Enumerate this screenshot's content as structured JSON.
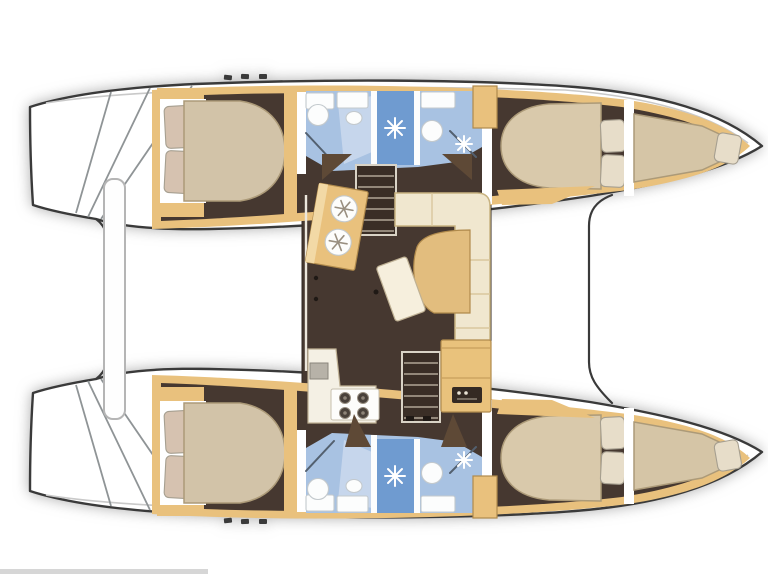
{
  "figure": {
    "kind": "catamaran-interior-floor-plan",
    "view": "top-down",
    "bow_direction": "right"
  },
  "palette": {
    "background": "#ffffff",
    "outline": "#3a3a3a",
    "hull_white": "#ffffff",
    "floor_dark": "#463830",
    "trim_tan": "#e9c17d",
    "unit_light": "#f2d9a6",
    "wedge_dark": "#5e4936",
    "bed_cream": "#d2c3a8",
    "pillow_blush": "#d6c2b0",
    "pillow_cream": "#e7ddc9",
    "berth_cream": "#d9c9ab",
    "bow_cream": "#d5c5a6",
    "bath_blue": "#a8c2e2",
    "bath_pale": "#c6d6ec",
    "shower_blue": "#6f9bd0",
    "fixture_white": "#fcfdfd",
    "settee_cream": "#f0e7cf",
    "settee_tan": "#e2bd7e",
    "table_white": "#f6efdd",
    "counter_white": "#f4f0e4",
    "sink_gray": "#b7b2a8",
    "stove_white": "#fdfdfb",
    "burner_dark": "#49413a",
    "stairs_dark": "#3a2e26",
    "nav_tan": "#e9c27c",
    "panel_dark": "#342a23",
    "panel_dot": "#e8e2d4",
    "davit_white": "#fefefe",
    "scan_line": "#cfcfcf",
    "accent_dark": "#1f1915"
  },
  "vessel": {
    "salon": {
      "fixtures": [
        "galley-sink-unit-two-round-basins",
        "galley-L-counter",
        "four-burner-stove",
        "galley-sink",
        "L-shaped-settee",
        "tan-salon-table",
        "white-stool",
        "chart-table",
        "instrument-panel",
        "port-companionway-stairs",
        "starboard-companionway-stairs",
        "door-swing-wedges"
      ]
    },
    "port_hull": {
      "rooms": [
        {
          "name": "aft-double-cabin",
          "fixtures": [
            "double-berth",
            "two-pillows",
            "wardrobe"
          ]
        },
        {
          "name": "aft-head",
          "fixtures": [
            "wash-basin",
            "toilet",
            "shower-stall"
          ]
        },
        {
          "name": "forward-head",
          "fixtures": [
            "wash-basin",
            "counter",
            "shower-corner"
          ]
        },
        {
          "name": "forward-double-cabin",
          "fixtures": [
            "double-berth",
            "two-pillows"
          ]
        },
        {
          "name": "bow-berth",
          "fixtures": [
            "single-berth",
            "pillow"
          ]
        }
      ]
    },
    "starboard_hull": {
      "rooms": [
        {
          "name": "aft-double-cabin",
          "fixtures": [
            "double-berth",
            "two-pillows",
            "wardrobe"
          ]
        },
        {
          "name": "aft-head",
          "fixtures": [
            "wash-basin",
            "toilet",
            "shower-stall"
          ]
        },
        {
          "name": "forward-head",
          "fixtures": [
            "wash-basin",
            "counter",
            "shower-corner"
          ]
        },
        {
          "name": "forward-double-cabin",
          "fixtures": [
            "double-berth",
            "two-pillows"
          ]
        },
        {
          "name": "bow-berth",
          "fixtures": [
            "single-berth",
            "pillow"
          ]
        }
      ]
    },
    "exterior": {
      "features": [
        "twin-transom-swim-steps",
        "stern-davit-beam",
        "foredeck-cross-edge",
        "pointed-bows",
        "deck-cleats"
      ]
    }
  }
}
